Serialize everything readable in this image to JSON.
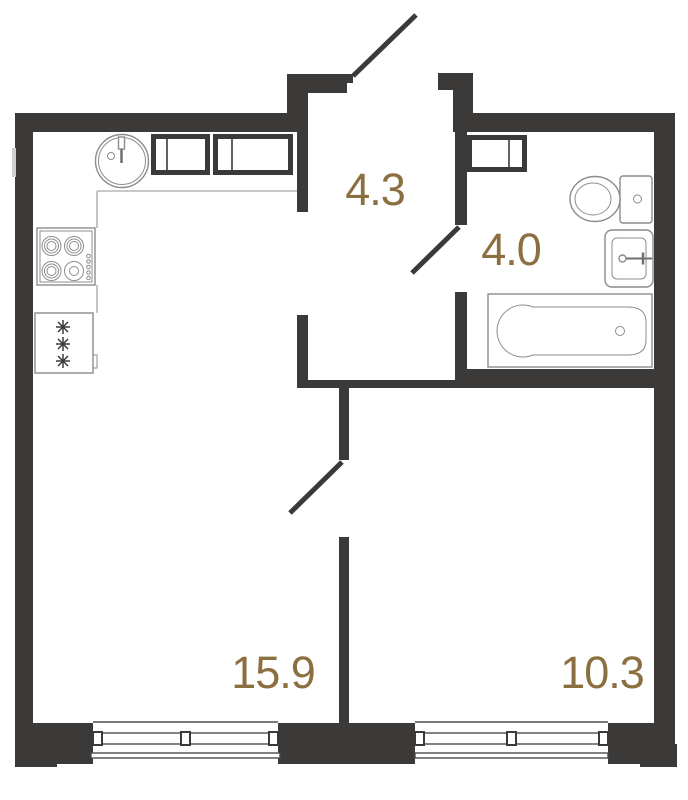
{
  "plan": {
    "type": "apartment-floor-plan"
  },
  "rooms": [
    {
      "name": "hallway",
      "area": "4.3"
    },
    {
      "name": "bathroom",
      "area": "4.0"
    },
    {
      "name": "living-kitchen",
      "area": "15.9"
    },
    {
      "name": "bedroom",
      "area": "10.3"
    }
  ],
  "fixtures": [
    "kitchen-sink",
    "kitchen-cabinets",
    "hob-4-burners",
    "fridge",
    "bathroom-cabinet",
    "toilet",
    "washbasin",
    "bathtub",
    "entrance-door-swing",
    "bathroom-door-swing",
    "bedroom-door-swing",
    "window-living",
    "window-bedroom"
  ],
  "colors": {
    "wall": "#3b3a38",
    "label": "#8c6f40",
    "fixture": "#8c8c8c",
    "counter": "#b5b5b5",
    "window": "#4d4d4d",
    "background": "#ffffff"
  }
}
